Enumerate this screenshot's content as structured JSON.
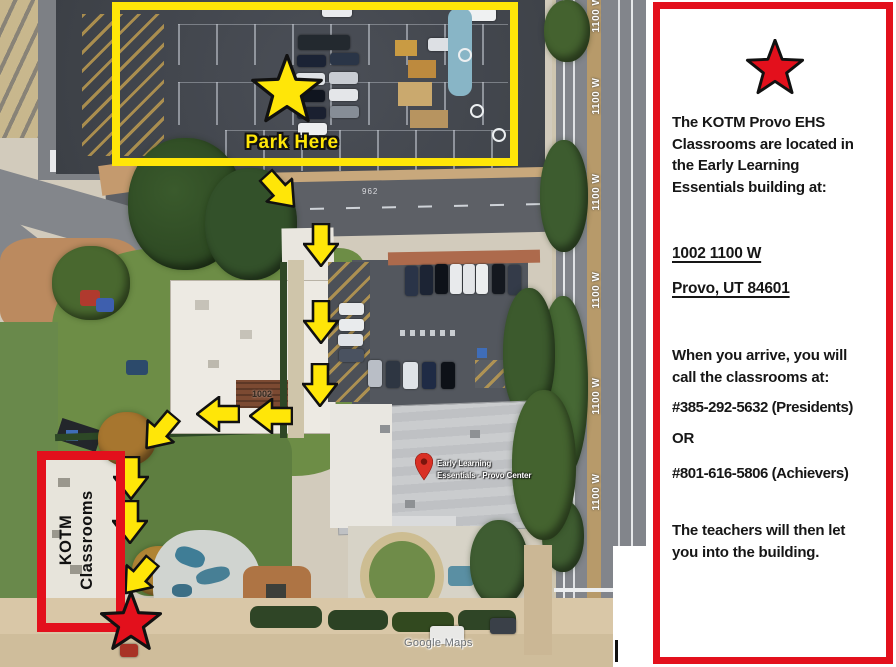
{
  "map": {
    "park_here_label": "Park Here",
    "kotm_label_line1": "KOTM",
    "kotm_label_line2": "Classrooms",
    "street_label": "1100 W",
    "road_pavement_number": "962",
    "building_number": "1002",
    "marker_label_line1": "Early Learning",
    "marker_label_line2": "Essentials - Provo Center",
    "watermark": "Google Maps",
    "colors": {
      "annotation_yellow": "#ffe608",
      "annotation_red": "#e3101c",
      "marker_red": "#d93025"
    }
  },
  "panel": {
    "para1": [
      "The KOTM Provo EHS",
      "Classrooms are located in",
      "the Early Learning",
      "Essentials building at:"
    ],
    "address_line1": "1002 1100 W",
    "address_line2": "Provo, UT 84601",
    "arrival": [
      "When you arrive, you will",
      "call the classrooms at:"
    ],
    "phone_presidents": "#385-292-5632 (Presidents)",
    "or_label": "OR",
    "phone_achievers": "#801-616-5806 (Achievers)",
    "closing": [
      "The teachers will then let",
      "you into the building."
    ]
  }
}
